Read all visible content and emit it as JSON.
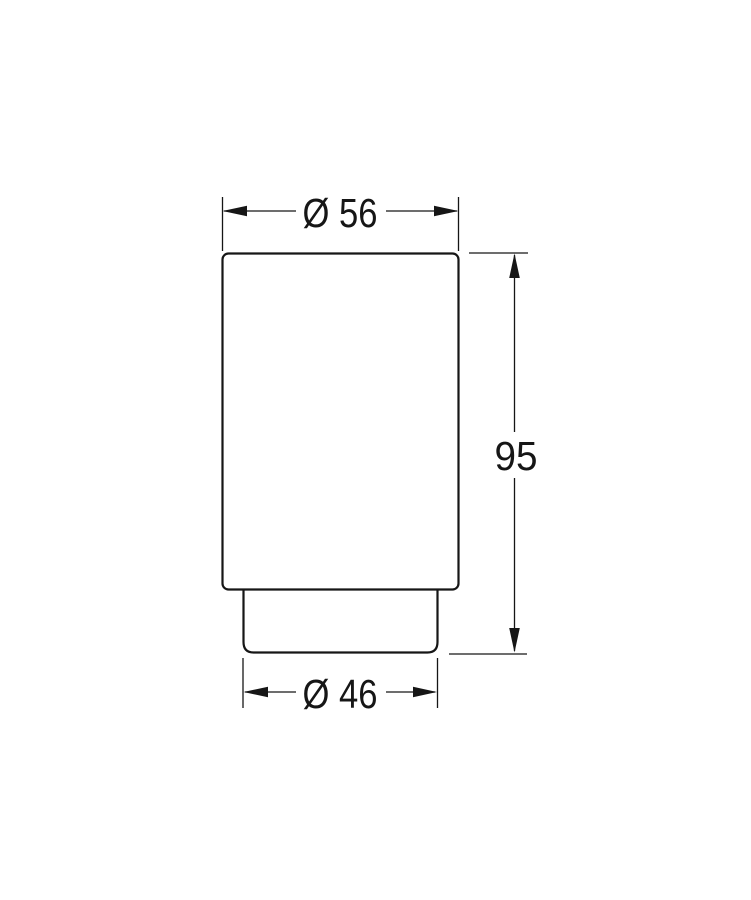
{
  "page": {
    "background_color": "#ffffff"
  },
  "drawing": {
    "kind": "technical-dimension-drawing",
    "object": "tumbler side elevation with stepped base",
    "line_color": "#161616",
    "fill_color": "#ffffff",
    "dimensions": {
      "top_diameter": {
        "label": "Ø 56",
        "value": 56
      },
      "height": {
        "label": "95",
        "value": 95
      },
      "bottom_diameter": {
        "label": "Ø 46",
        "value": 46
      }
    }
  }
}
